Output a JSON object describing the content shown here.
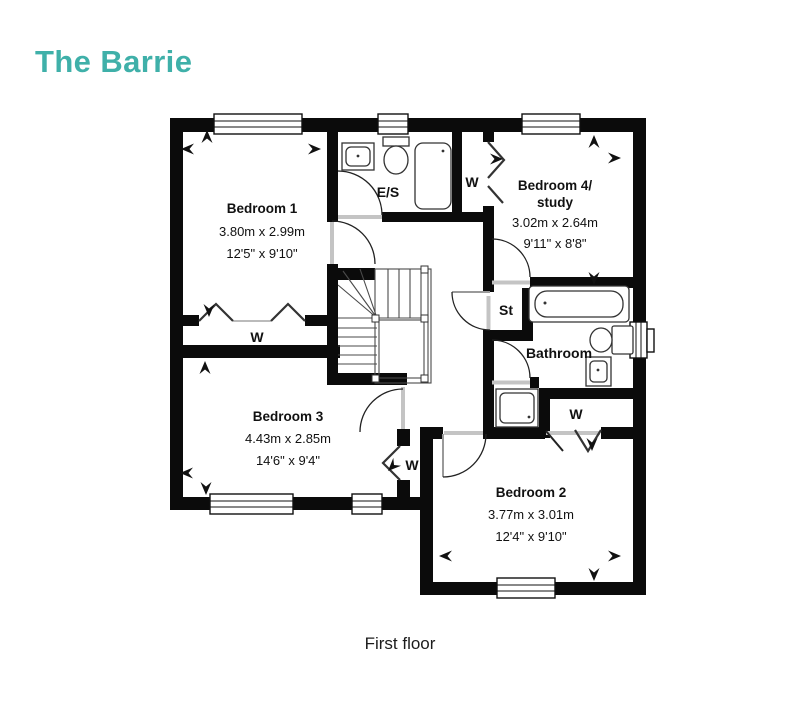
{
  "title": "The Barrie",
  "caption": "First floor",
  "accent_color": "#3FB0A9",
  "rooms": {
    "bedroom1": {
      "name": "Bedroom 1",
      "metric": "3.80m x 2.99m",
      "imperial": "12'5\" x 9'10\""
    },
    "bedroom4": {
      "name": "Bedroom 4/",
      "name2": "study",
      "metric": "3.02m x 2.64m",
      "imperial": "9'11\" x 8'8\""
    },
    "bedroom3": {
      "name": "Bedroom 3",
      "metric": "4.43m x 2.85m",
      "imperial": "14'6\" x 9'4\""
    },
    "bedroom2": {
      "name": "Bedroom 2",
      "metric": "3.77m x 3.01m",
      "imperial": "12'4\" x 9'10\""
    },
    "ensuite": {
      "name": "E/S"
    },
    "bathroom": {
      "name": "Bathroom"
    },
    "store": {
      "name": "St"
    }
  },
  "wardrobe_label": "W"
}
